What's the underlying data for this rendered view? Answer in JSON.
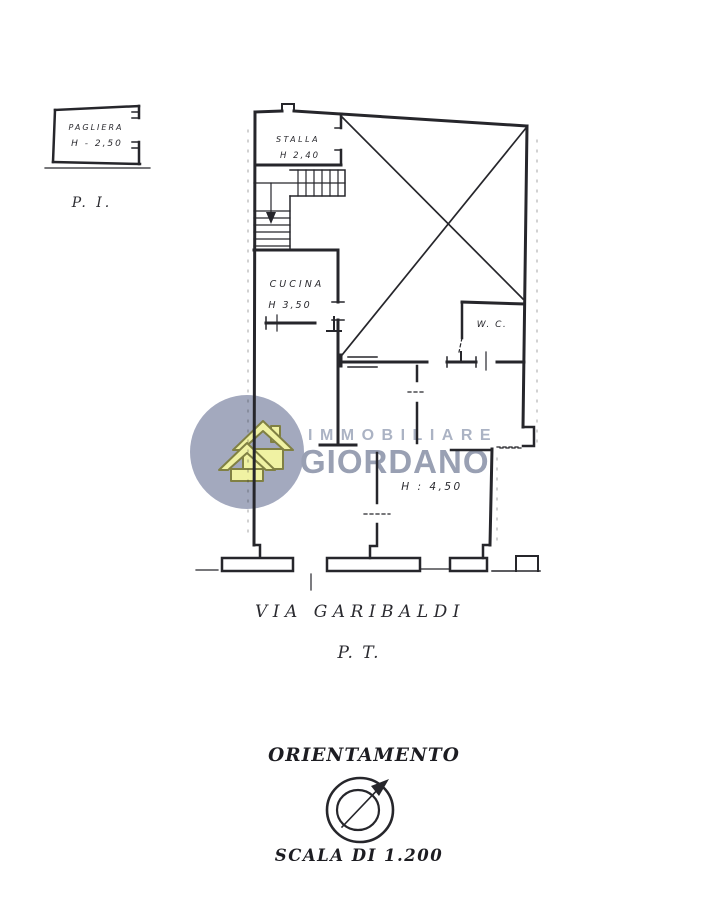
{
  "ink": "#26262b",
  "upper_floor_fragment": {
    "room": "PAGLIERA",
    "height": "H - 2,50",
    "floor_label": "P. I."
  },
  "plan": {
    "stalla": {
      "name": "STALLA",
      "height": "H 2,40"
    },
    "cucina": {
      "name": "CUCINA",
      "height": "H 3,50"
    },
    "wc": {
      "name": "W. C."
    },
    "sala": {
      "height": "H : 4,50"
    },
    "street_label": "VIA GARIBALDI",
    "floor_label": "P. T."
  },
  "watermark": {
    "line1": "IMMOBILIARE",
    "line2": "GIORDANO",
    "circle_color": "#9aa0b8",
    "house_fill": "#eff19a",
    "house_stroke": "#73732f",
    "text1_color": "#a3abbe",
    "text2_color": "#8e96ab"
  },
  "orientation": {
    "title": "ORIENTAMENTO",
    "scale_label": "SCALA DI 1.200"
  }
}
